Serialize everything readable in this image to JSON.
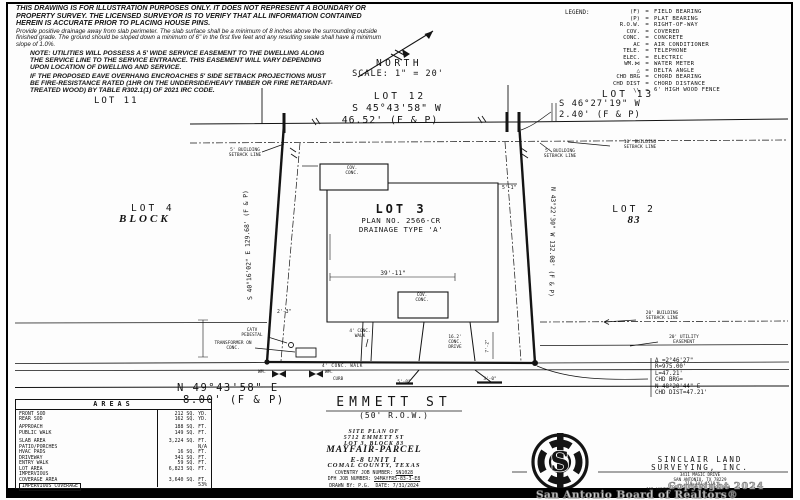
{
  "disclaimer": {
    "p1": "THIS DRAWING IS FOR ILLUSTRATION PURPOSES ONLY.  IT DOES NOT REPRESENT A BOUNDARY OR PROPERTY SURVEY.  THE LICENSED SURVEYOR IS TO VERIFY THAT ALL INFORMATION CONTAINED HEREIN IS ACCURATE PRIOR TO PLACING HOUSE PINS.",
    "p2": "Provide positive drainage away from slab perimeter. The slab surface shall be a minimum of 8 inches above the surrounding outside finished grade. The ground should be sloped down a minimum of 6\" in the first five feet and any resulting swale shall have a minimum slope of 1.0%.",
    "p3": "NOTE: UTILITIES WILL POSSESS A 5' WIDE SERVICE EASEMENT TO THE DWELLING ALONG THE SERVICE LINE TO THE SERVICE ENTRANCE. THIS EASEMENT WILL VARY DEPENDING UPON LOCATION OF DWELLING AND SERVICE.",
    "p4": "IF THE PROPOSED EAVE OVERHANG ENCROACHES 5' SIDE SETBACK PROJECTIONS MUST BE FIRE-RESISTANCE RATED (1HR ON THE UNDERSIDE/HEAVY TIMBER OR FIRE RETARDANT-TREATED WOOD) BY TABLE R302.1(1) OF 2021 IRC CODE."
  },
  "north": {
    "label": "NORTH",
    "scale": "SCALE:  1\" = 20'"
  },
  "legend": {
    "title": "LEGEND:",
    "eq": "=",
    "items": [
      {
        "abbr": "(F)",
        "meaning": "FIELD BEARING"
      },
      {
        "abbr": "(P)",
        "meaning": "PLAT BEARING"
      },
      {
        "abbr": "R.O.W.",
        "meaning": "RIGHT-OF-WAY"
      },
      {
        "abbr": "COV.",
        "meaning": "COVERED"
      },
      {
        "abbr": "CONC.",
        "meaning": "CONCRETE"
      },
      {
        "abbr": "AC",
        "meaning": "AIR CONDITIONER"
      },
      {
        "abbr": "TELE.",
        "meaning": "TELEPHONE"
      },
      {
        "abbr": "ELEC.",
        "meaning": "ELECTRIC"
      },
      {
        "abbr": "WM.⋈",
        "meaning": "WATER METER"
      },
      {
        "abbr": "△",
        "meaning": "DELTA ANGLE"
      },
      {
        "abbr": "CHD BRG",
        "meaning": "CHORD BEARING"
      },
      {
        "abbr": "CHD DIST",
        "meaning": "CHORD DISTANCE"
      },
      {
        "abbr": "\\\\",
        "meaning": "6' HIGH WOOD FENCE"
      }
    ]
  },
  "plat": {
    "lots": {
      "lot11": "LOT 11",
      "lot12": "LOT 12",
      "lot13": "LOT 13",
      "lot4": "LOT 4",
      "block_word": "BLOCK",
      "lot3": "LOT 3",
      "plan": "PLAN NO. 2566-CR",
      "drainage": "DRAINAGE TYPE 'A'",
      "lot2": "LOT 2",
      "block_num": "83"
    },
    "bearings": {
      "top": "S 45°43'58\" W",
      "top_dist": "46.52' (F & P)",
      "tr": "S 46°27'19\" W",
      "tr_dist": "2.40' (F & P)",
      "west": "S 40°16'02\" E 129.68' (F & P)",
      "east": "N 43°22'30\" W 132.08' (F & P)",
      "front": "N 49°43'58\" E",
      "front_dist": "8.00' (F & P)"
    },
    "setbacks": {
      "left5": "5' BUILDING SETBACK LINE",
      "right5": "5' BUILDING SETBACK LINE",
      "right10": "10' BUILDING SETBACK LINE",
      "bldg20": "20' BUILDING SETBACK LINE",
      "util20": "20' UTILITY EASEMENT"
    },
    "labels": {
      "cov_top": "COV. CONC.",
      "cov_rear": "COV. CONC.",
      "catv": "CATV PEDESTAL",
      "transformer": "TRANSFORMER ON CONC.",
      "entry_walk": "4' CONC. WALK",
      "public_walk": "4' CONC. WALK",
      "curb": "CURB",
      "drive": "16.2' CONC. DRIVE",
      "wm_left": "WM.",
      "wm_right": "WM."
    },
    "dims": {
      "d3911": "39'-11\"",
      "d51": "5'-1\"",
      "d23": "2'-3\"",
      "d72": "7'-2\"",
      "d50": "5'-0\"",
      "d30": "3'-0\""
    },
    "curve": {
      "l1": "Δ =2°46'27\"",
      "l2": "R=975.00'",
      "l3": "L=47.21'",
      "l4": "CHD BRG=",
      "l5": "N 48°20'44\" E",
      "l6": "CHD DIST=47.21'"
    },
    "street": {
      "name": "EMMETT ST",
      "row": "(50' R.O.W.)"
    }
  },
  "areas_table": {
    "title": "AREAS",
    "rows": [
      {
        "label": "FRONT SOD",
        "value": "212 SQ. YD."
      },
      {
        "label": "REAR SOD",
        "value": "162 SQ. YD."
      },
      {
        "label": "APPROACH",
        "value": "188 SQ. FT."
      },
      {
        "label": "PUBLIC WALK",
        "value": "149 SQ. FT."
      },
      {
        "label": "SLAB AREA",
        "value": "3,224 SQ. FT."
      },
      {
        "label": "PATIO/PORCHES",
        "value": "N/A"
      },
      {
        "label": "HVAC PADS",
        "value": "16 SQ. FT."
      },
      {
        "label": "DRIVEWAY",
        "value": "341 SQ. FT."
      },
      {
        "label": "ENTRY WALK",
        "value": "59 SQ. FT."
      },
      {
        "label": "LOT AREA",
        "value": "6,823 SQ. FT."
      },
      {
        "label": "IMPERVIOUS",
        "value": ""
      },
      {
        "label": "COVERAGE AREA",
        "value": "3,640 SQ. FT."
      },
      {
        "label": "IMPERVIOUS COVERAGE",
        "value": "53%"
      }
    ]
  },
  "titleblock": {
    "l1": "SITE PLAN OF",
    "l2": "5712 EMMETT ST",
    "l3": "LOT 3, BLOCK 83",
    "l4": "MAYFAIR-PARCEL",
    "l5": "E-8 UNIT 1",
    "l6": "COMAL COUNTY, TEXAS",
    "coventry_label": "COVENTRY JOB NUMBER:",
    "coventry": "SN1028",
    "dfh_label": "DFH JOB NUMBER:",
    "dfh": "94MAYFR5-83-3-E8",
    "drawn_label": "DRAWN BY:",
    "drawn": "P.G.",
    "date_label": "DATE:",
    "date": "7/31/2024"
  },
  "surveyor": {
    "name1": "SINCLAIR LAND",
    "name2": "SURVEYING, INC.",
    "addr1": "3411 MAGIC DRIVE",
    "addr2": "SAN ANTONIO, TX 78229",
    "phone": "210-341-4518",
    "firm": "TBPELS FIRM NO. 10058900",
    "job": "JOB NUMBER:",
    "logo_letter": "S"
  },
  "watermark": {
    "copyright": "Copyright 2024",
    "board": "San Antonio Board of Realtors®"
  }
}
